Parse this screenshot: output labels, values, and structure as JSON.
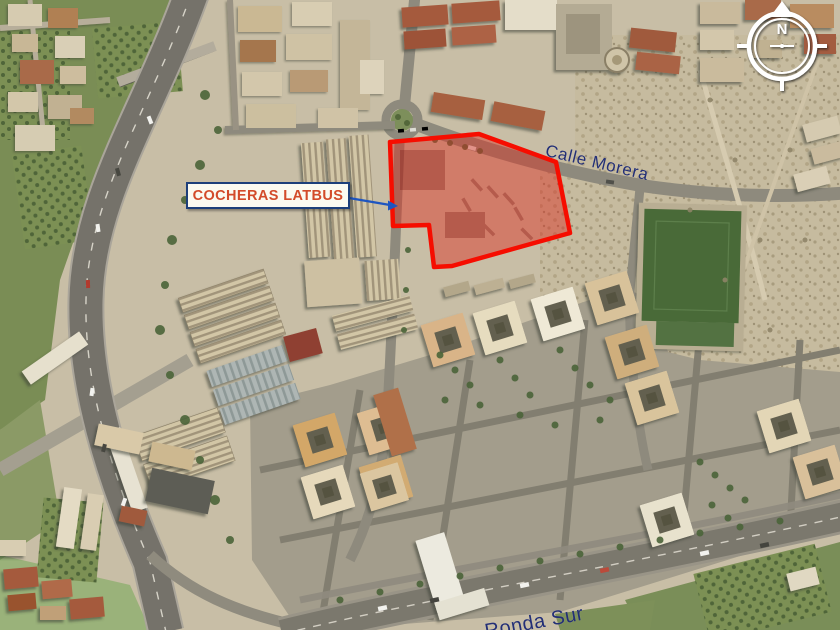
{
  "map": {
    "site_label": {
      "text": "COCHERAS LATBUS",
      "text_color": "#d34b2a",
      "border_color": "#1d3f7a",
      "background_color": "#fbfaf1"
    },
    "connector": {
      "color": "#1e55c0"
    },
    "streets": [
      {
        "name": "Calle Morera",
        "color": "#232f76"
      },
      {
        "name": "Ronda Sur",
        "color": "#232f76"
      }
    ],
    "compass": {
      "north_letter": "N",
      "color": "#ffffff"
    },
    "highlight": {
      "label": "COCHERAS LATBUS",
      "fill_color": "#dc2d20",
      "fill_opacity": 0.45,
      "stroke_color": "#f60d00"
    },
    "terrain": {
      "ground_color": "#c8bea6",
      "vegetation_color": "#7a8d55",
      "sports_field_color": "#4a6a39",
      "road_color": "#7b786d"
    }
  }
}
